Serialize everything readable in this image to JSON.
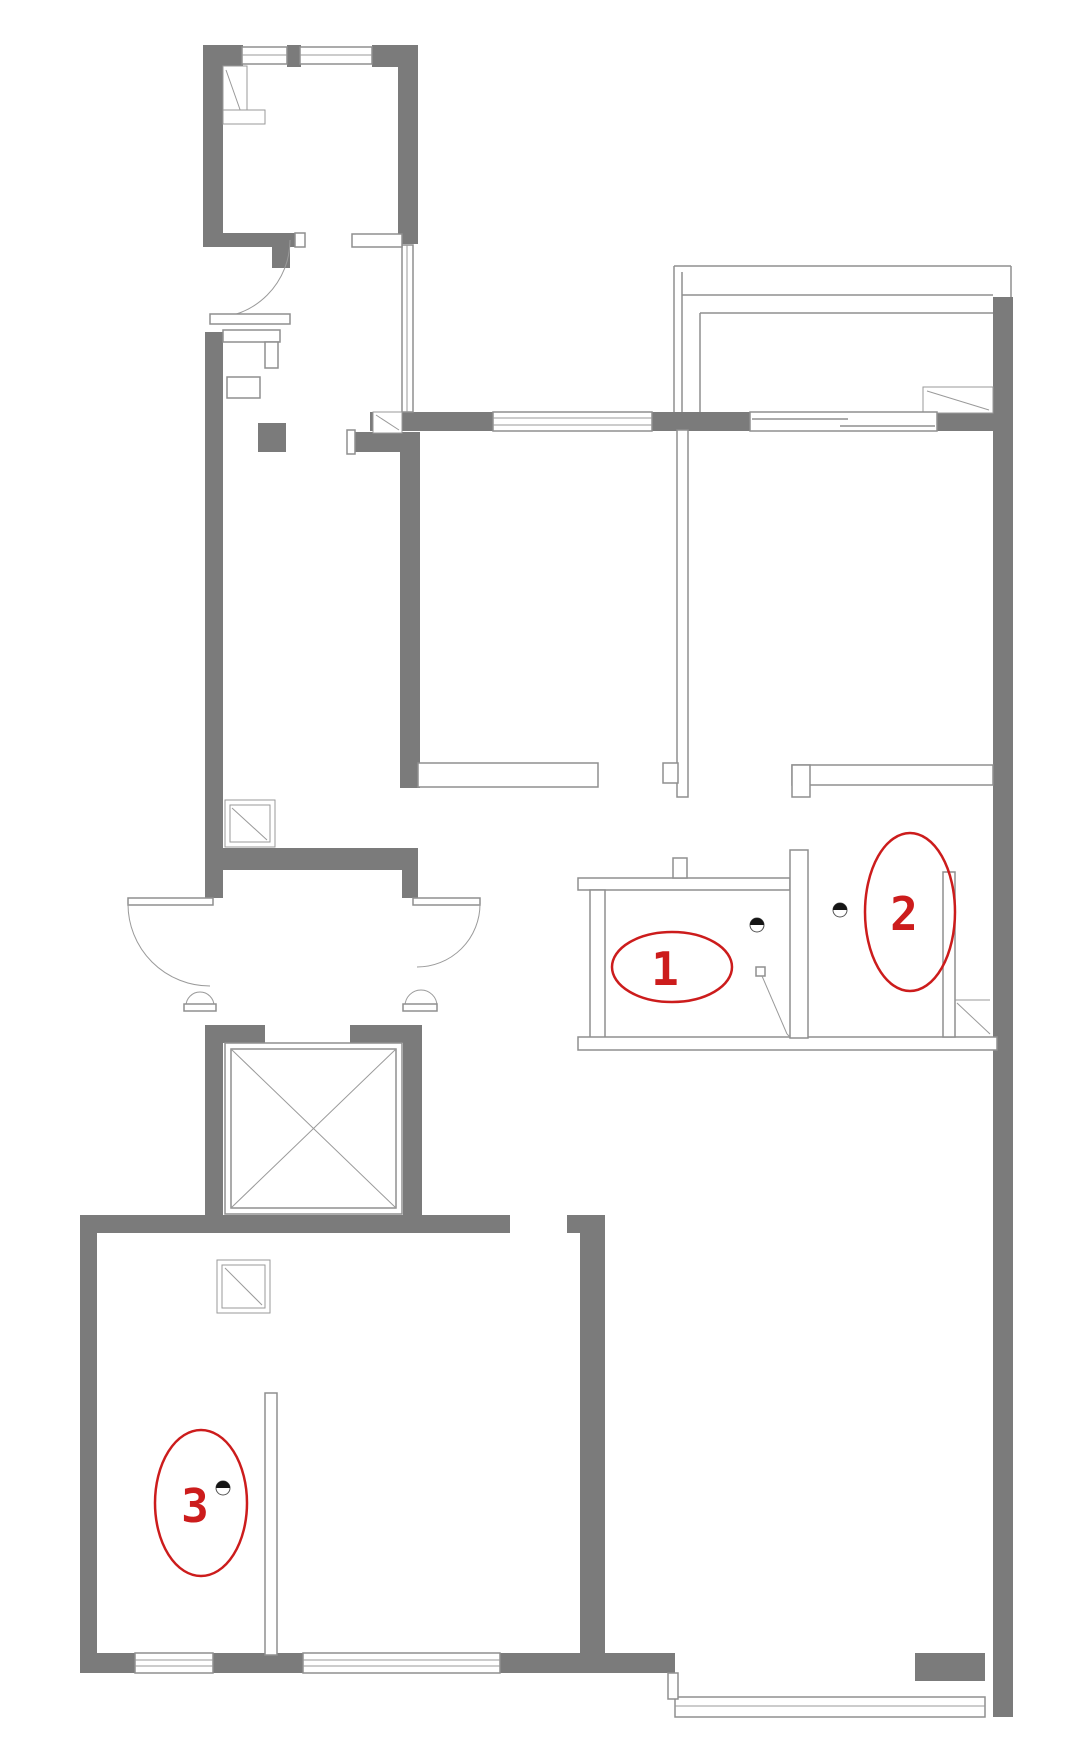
{
  "page": {
    "background": "#ffffff",
    "type": "floor-plan"
  },
  "colors": {
    "wall_gray": "#7b7b7b",
    "outline_gray": "#8f8f8f",
    "annotation_red": "#cc1c1c",
    "light_black": "#151515"
  },
  "annotations": [
    {
      "id": "1",
      "label": "1",
      "ellipse": {
        "cx": 672,
        "cy": 967,
        "rx": 60,
        "ry": 35
      },
      "text": {
        "x": 665,
        "y": 985
      }
    },
    {
      "id": "2",
      "label": "2",
      "ellipse": {
        "cx": 910,
        "cy": 912,
        "rx": 45,
        "ry": 79
      },
      "text": {
        "x": 904,
        "y": 930
      }
    },
    {
      "id": "3",
      "label": "3",
      "ellipse": {
        "cx": 201,
        "cy": 1503,
        "rx": 46,
        "ry": 73
      },
      "text": {
        "x": 195,
        "y": 1522
      }
    }
  ],
  "lights": [
    {
      "x": 757,
      "y": 925
    },
    {
      "x": 840,
      "y": 910
    },
    {
      "x": 223,
      "y": 1488
    }
  ],
  "icon_legend": {
    "annotation_marker": "red-ellipse-callout",
    "light": "ceiling-light-half-dot-icon",
    "elevator": "elevator-x-box",
    "window": "triple-line-window",
    "door": "quarter-arc-door"
  }
}
